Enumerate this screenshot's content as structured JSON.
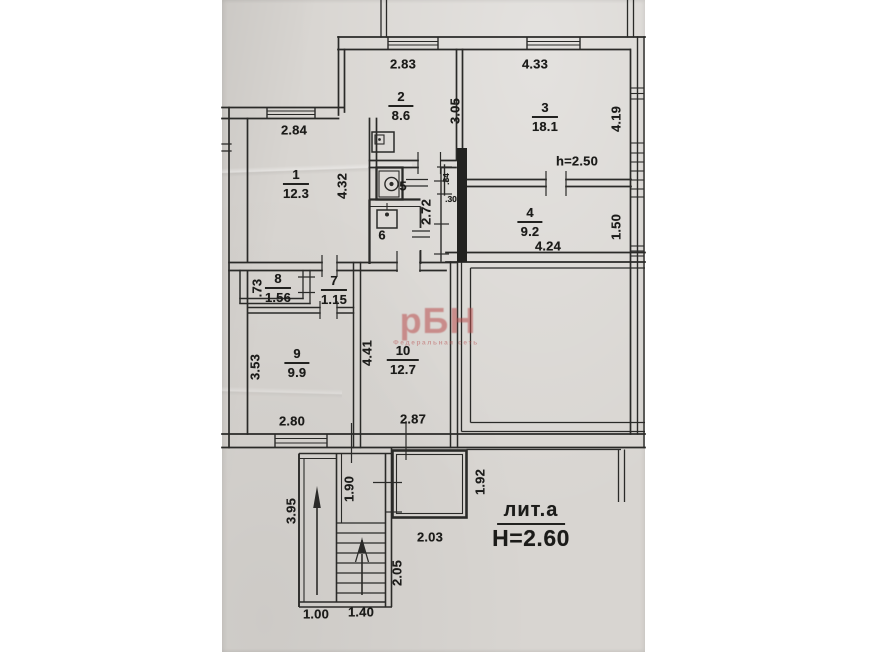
{
  "colors": {
    "paper": "#d8d5d1",
    "ink": "#2a2a28",
    "watermark": "#b94e4e"
  },
  "watermark": {
    "text": "рБН",
    "subtext": "Федеральная сеть"
  },
  "liter_block": {
    "liter": "лит.а",
    "height_label": "Н=2.60"
  },
  "rooms": [
    {
      "num": "1",
      "area": "12.3",
      "x": 296,
      "y": 184
    },
    {
      "num": "2",
      "area": "8.6",
      "x": 401,
      "y": 106
    },
    {
      "num": "3",
      "area": "18.1",
      "x": 545,
      "y": 117
    },
    {
      "num": "4",
      "area": "9.2",
      "x": 530,
      "y": 222
    },
    {
      "num": "5",
      "area": null,
      "x": 403,
      "y": 186
    },
    {
      "num": "6",
      "area": null,
      "x": 382,
      "y": 235
    },
    {
      "num": "7",
      "area": "1.15",
      "x": 334,
      "y": 290
    },
    {
      "num": "8",
      "area": "1.56",
      "x": 278,
      "y": 288
    },
    {
      "num": "9",
      "area": "9.9",
      "x": 297,
      "y": 363
    },
    {
      "num": "10",
      "area": "12.7",
      "x": 403,
      "y": 360
    }
  ],
  "dimensions": [
    {
      "text": "2.83",
      "x": 403,
      "y": 64,
      "rot": false
    },
    {
      "text": "4.33",
      "x": 535,
      "y": 64,
      "rot": false
    },
    {
      "text": "2.84",
      "x": 294,
      "y": 130,
      "rot": false
    },
    {
      "text": "3.05",
      "x": 455,
      "y": 111,
      "rot": true
    },
    {
      "text": "4.19",
      "x": 616,
      "y": 119,
      "rot": true
    },
    {
      "text": "h=2.50",
      "x": 577,
      "y": 161,
      "rot": false
    },
    {
      "text": "4.32",
      "x": 342,
      "y": 186,
      "rot": true
    },
    {
      "text": "2.72",
      "x": 426,
      "y": 212,
      "rot": true
    },
    {
      "text": ".84",
      "x": 446,
      "y": 179,
      "rot": true,
      "small": true
    },
    {
      "text": ".30",
      "x": 451,
      "y": 199,
      "rot": false,
      "small": true
    },
    {
      "text": "1.50",
      "x": 616,
      "y": 227,
      "rot": true
    },
    {
      "text": "4.24",
      "x": 548,
      "y": 246,
      "rot": false
    },
    {
      "text": ".73",
      "x": 257,
      "y": 288,
      "rot": true
    },
    {
      "text": "3.53",
      "x": 255,
      "y": 367,
      "rot": true
    },
    {
      "text": "4.41",
      "x": 367,
      "y": 353,
      "rot": true
    },
    {
      "text": "2.80",
      "x": 292,
      "y": 421,
      "rot": false
    },
    {
      "text": "2.87",
      "x": 413,
      "y": 419,
      "rot": false
    },
    {
      "text": "3.95",
      "x": 291,
      "y": 511,
      "rot": true
    },
    {
      "text": "1.90",
      "x": 349,
      "y": 489,
      "rot": true
    },
    {
      "text": "1.92",
      "x": 480,
      "y": 482,
      "rot": true
    },
    {
      "text": "2.03",
      "x": 430,
      "y": 537,
      "rot": false
    },
    {
      "text": "2.05",
      "x": 397,
      "y": 573,
      "rot": true
    },
    {
      "text": "1.00",
      "x": 316,
      "y": 614,
      "rot": false
    },
    {
      "text": "1.40",
      "x": 361,
      "y": 612,
      "rot": false
    }
  ]
}
